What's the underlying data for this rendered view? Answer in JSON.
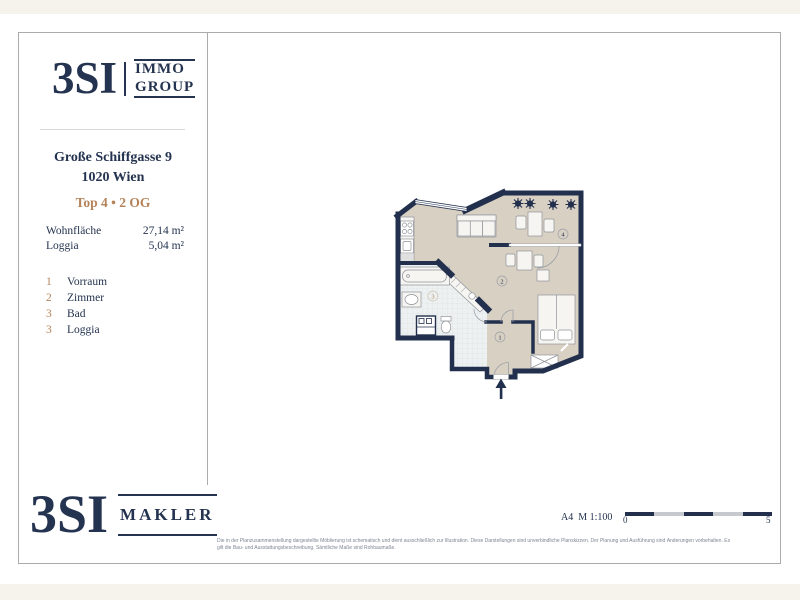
{
  "header_logo": {
    "brand": "3SI",
    "word1": "IMMO",
    "word2": "GROUP"
  },
  "property": {
    "address_line1": "Große Schiffgasse 9",
    "address_line2": "1020 Wien",
    "unit_label": "Top 4 • 2 OG",
    "area_rows": [
      {
        "label": "Wohnfläche",
        "value": "27,14 m²"
      },
      {
        "label": "Loggia",
        "value": "5,04 m²"
      }
    ],
    "room_rows": [
      {
        "num": "1",
        "label": "Vorraum"
      },
      {
        "num": "2",
        "label": "Zimmer"
      },
      {
        "num": "3",
        "label": "Bad"
      },
      {
        "num": "3",
        "label": "Loggia"
      }
    ]
  },
  "plan_markers": {
    "m1": "1",
    "m2": "2",
    "m3": "3",
    "m4": "4"
  },
  "footer": {
    "format_scale": "A4  M 1:100",
    "scale_zero": "0",
    "scale_five": "5",
    "disclaimer_line1": "Die in der Planzusammenstellung dargestellte Möblierung ist schematisch und dient ausschließlich zur Illustration. Diese Darstellungen sind unverbindliche Planskizzen. Der Planung und Ausführung sind Änderungen vorbehalten. Es",
    "disclaimer_line2": "gilt die Bau- und Ausstattungsbeschreibung. Sämtliche Maße sind Rohbaumaße."
  },
  "footer_logo": {
    "brand": "3SI",
    "word1": "MAKLER"
  },
  "colors": {
    "navy": "#24334f",
    "tan": "#b5835a",
    "wall": "#22304e",
    "floor_beige": "#d9d0c4",
    "tile": "#eef1f1",
    "page_cream": "#f6f3ec"
  }
}
